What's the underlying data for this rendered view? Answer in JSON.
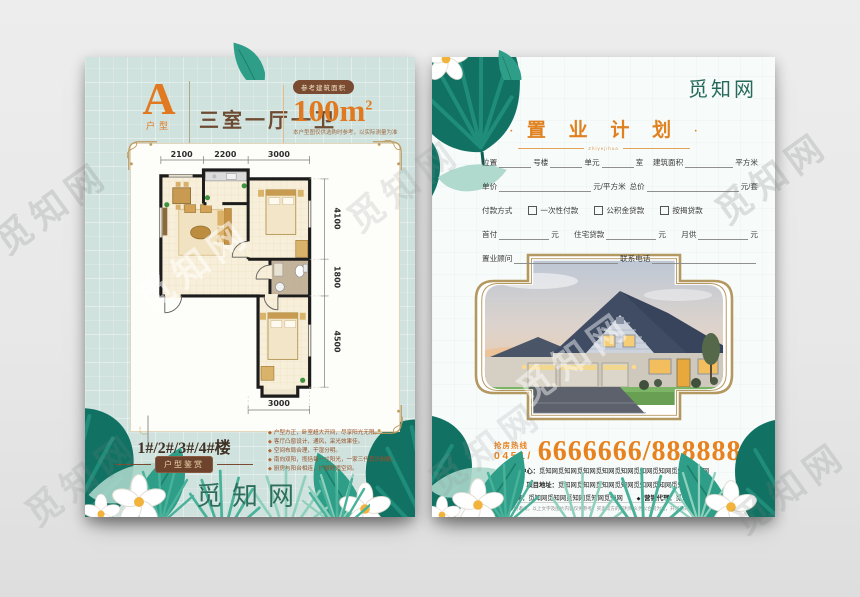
{
  "watermark": {
    "text": "觅知网"
  },
  "colors": {
    "accent_orange": "#e0791f",
    "hotline_orange": "#e8821e",
    "brand_teal": "#2e6e5c",
    "badge_brown": "#7a4a31",
    "frame_gold": "#b3985f",
    "left_page_bg": "#cfe2dd"
  },
  "left_page": {
    "type_letter": "A",
    "type_label": "户型",
    "layout_name": "三室一厅一卫",
    "area_badge": "参考建筑面积",
    "area_value": "100m",
    "area_sup": "2",
    "area_note": "本户型图仅供选购时参考，以实际测量为准",
    "plan": {
      "dims_top": [
        "2100",
        "2200",
        "3000"
      ],
      "dims_right": [
        "4100",
        "1800",
        "4500"
      ],
      "dim_bottom": "3000"
    },
    "buildings": "1#/2#/3#/4#楼",
    "badge": "户型鉴赏",
    "features": [
      "户型方正，卧室超大开间，尽享阳光无限。",
      "客厅凸窗设计，通风，采光效果佳。",
      "空间布局合理，干湿分明。",
      "南向双阳，揽括每一寸阳光，一家三代其乐融融。",
      "厨房与阳台相连，扩展舒适空间。"
    ],
    "logo": "觅知网"
  },
  "right_page": {
    "logo": "觅知网",
    "title": "置 业 计 划",
    "title_dot": "·",
    "title_sub": "Zhiyejihua",
    "form": {
      "row1": [
        "位置",
        "号楼",
        "单元",
        "室",
        "建筑面积",
        "平方米"
      ],
      "row2": [
        "单价",
        "元/平方米",
        "总价",
        "元/套"
      ],
      "payment_label": "付款方式",
      "payment_options": [
        "一次性付款",
        "公积金贷款",
        "按揭贷款"
      ],
      "row4": [
        "首付",
        "元",
        "住宅贷款",
        "元",
        "月供",
        "元"
      ],
      "row5": [
        "置业顾问",
        "联系电话"
      ]
    },
    "hotline": {
      "label": "抢房热线",
      "area_code": "0451/",
      "number": "6666666/888888"
    },
    "info_lines": [
      {
        "label": "售楼中心：",
        "value": "觅知网觅知网觅知网觅知网觅知网觅知网觅知网觅知网觅知网"
      },
      {
        "label": "项目地址：",
        "value": "觅知网觅知网觅知网觅知网觅知网觅知网觅知网"
      },
      {
        "label": "开发商：",
        "value": "觅知网觅知网觅知网觅知网觅知网"
      },
      {
        "label": "营销代理：",
        "value": "觅知网觅知网"
      }
    ],
    "disclaimer": "本广告不作为要约邀请，以上文字及图片内容仅供参考，买卖双方的权利和义务以合同为准，开发商对此保留解释权利。"
  }
}
